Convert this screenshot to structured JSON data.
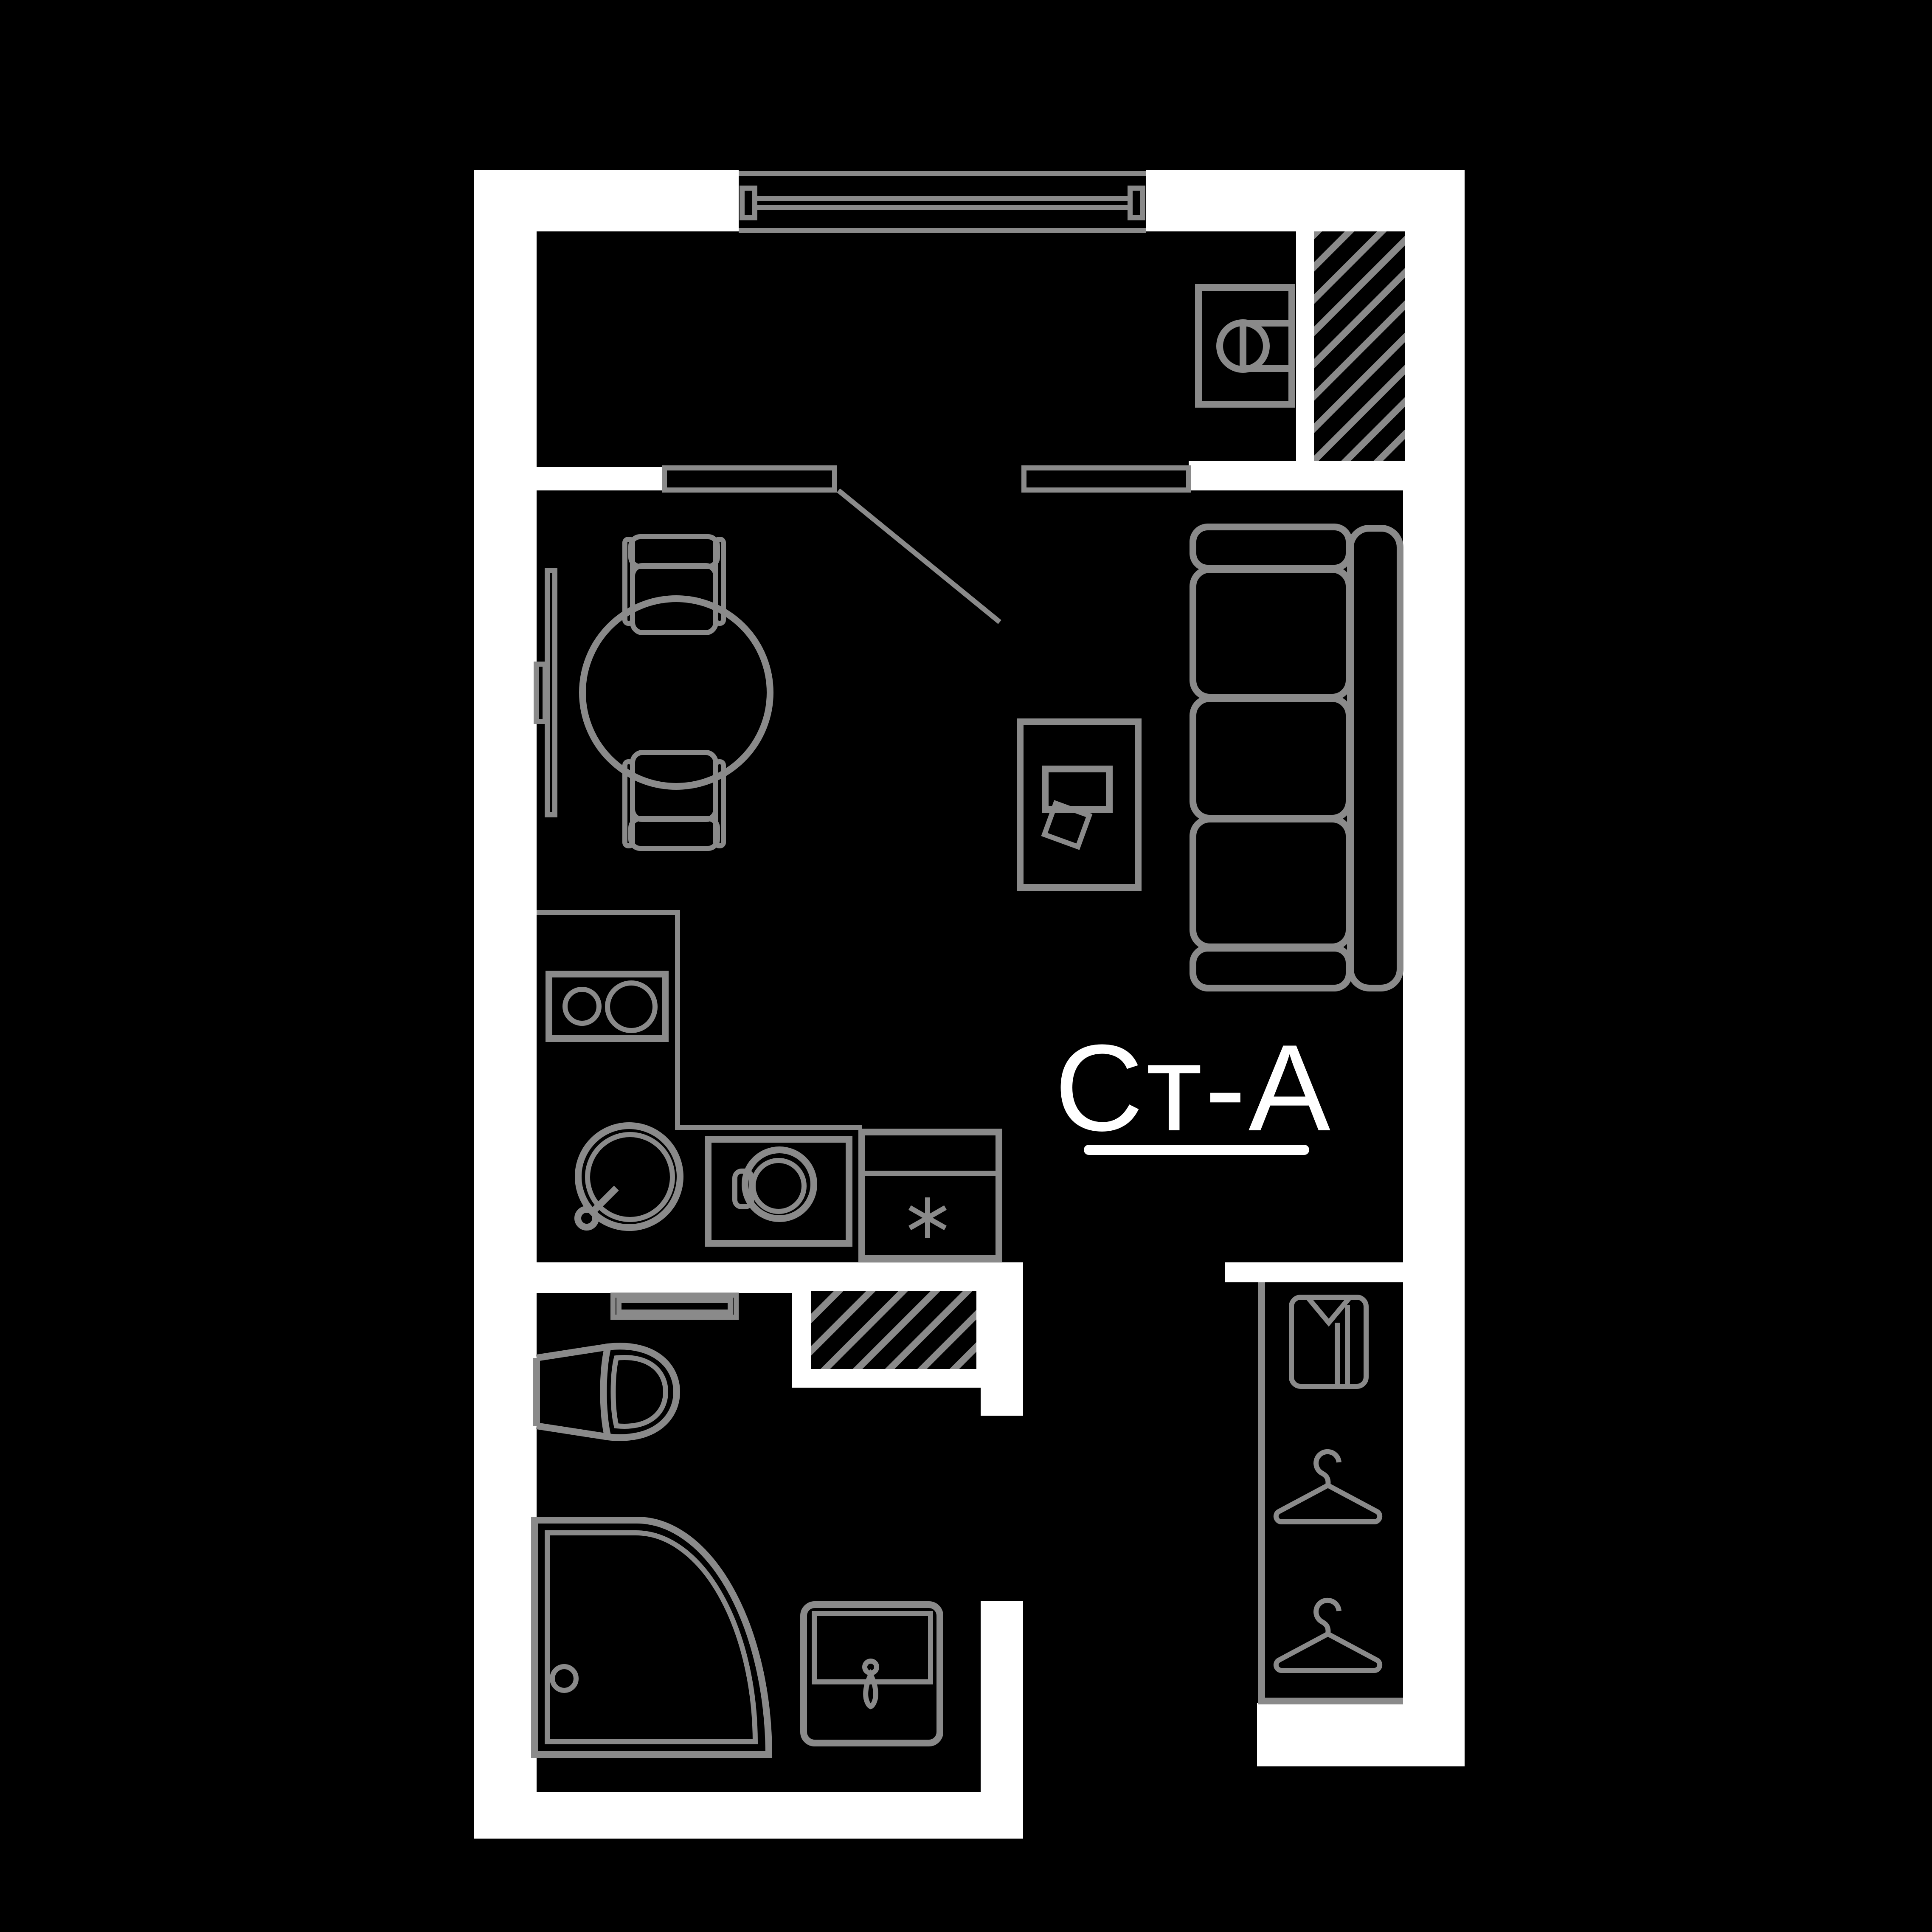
{
  "plan": {
    "label": "Ст-А",
    "kind": "studio-apartment-floor-plan"
  },
  "colors": {
    "bg": "#000000",
    "wall": "#ffffff",
    "line": "#8a8a8a",
    "text": "#ffffff"
  }
}
